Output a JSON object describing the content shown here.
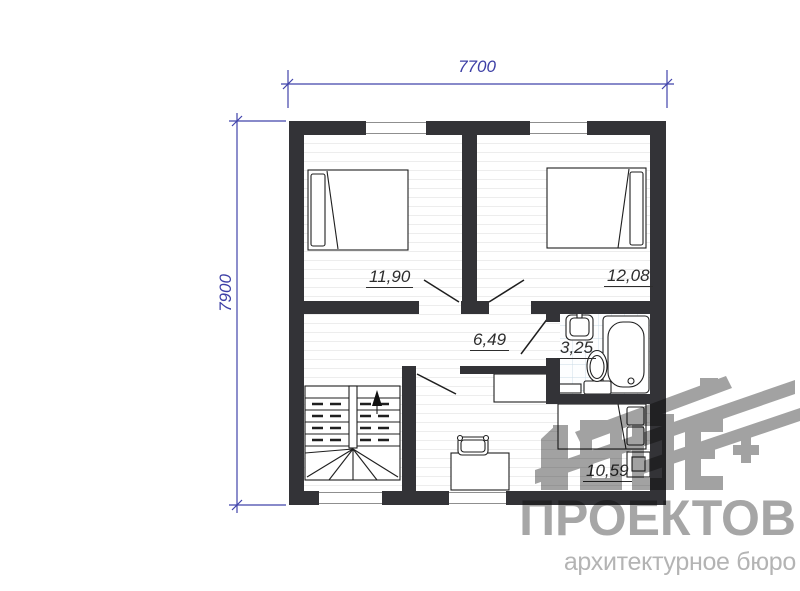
{
  "plan": {
    "dimensions": {
      "width": "7700",
      "height": "7900"
    },
    "rooms": [
      {
        "id": "bedroom-left",
        "area": "11,90"
      },
      {
        "id": "bedroom-right",
        "area": "12,08"
      },
      {
        "id": "hall",
        "area": "6,49"
      },
      {
        "id": "bathroom",
        "area": "3,25"
      },
      {
        "id": "study-bedroom",
        "area": "10,59"
      }
    ]
  },
  "watermark": {
    "title": "ПРОЕКТОВ",
    "subtitle": "архитектурное бюро"
  },
  "colors": {
    "wall": "#333337",
    "dimension": "#4143ab",
    "tile_line": "#c9dae6",
    "floor_line": "#ededed",
    "watermark": "#a2a2a2"
  }
}
